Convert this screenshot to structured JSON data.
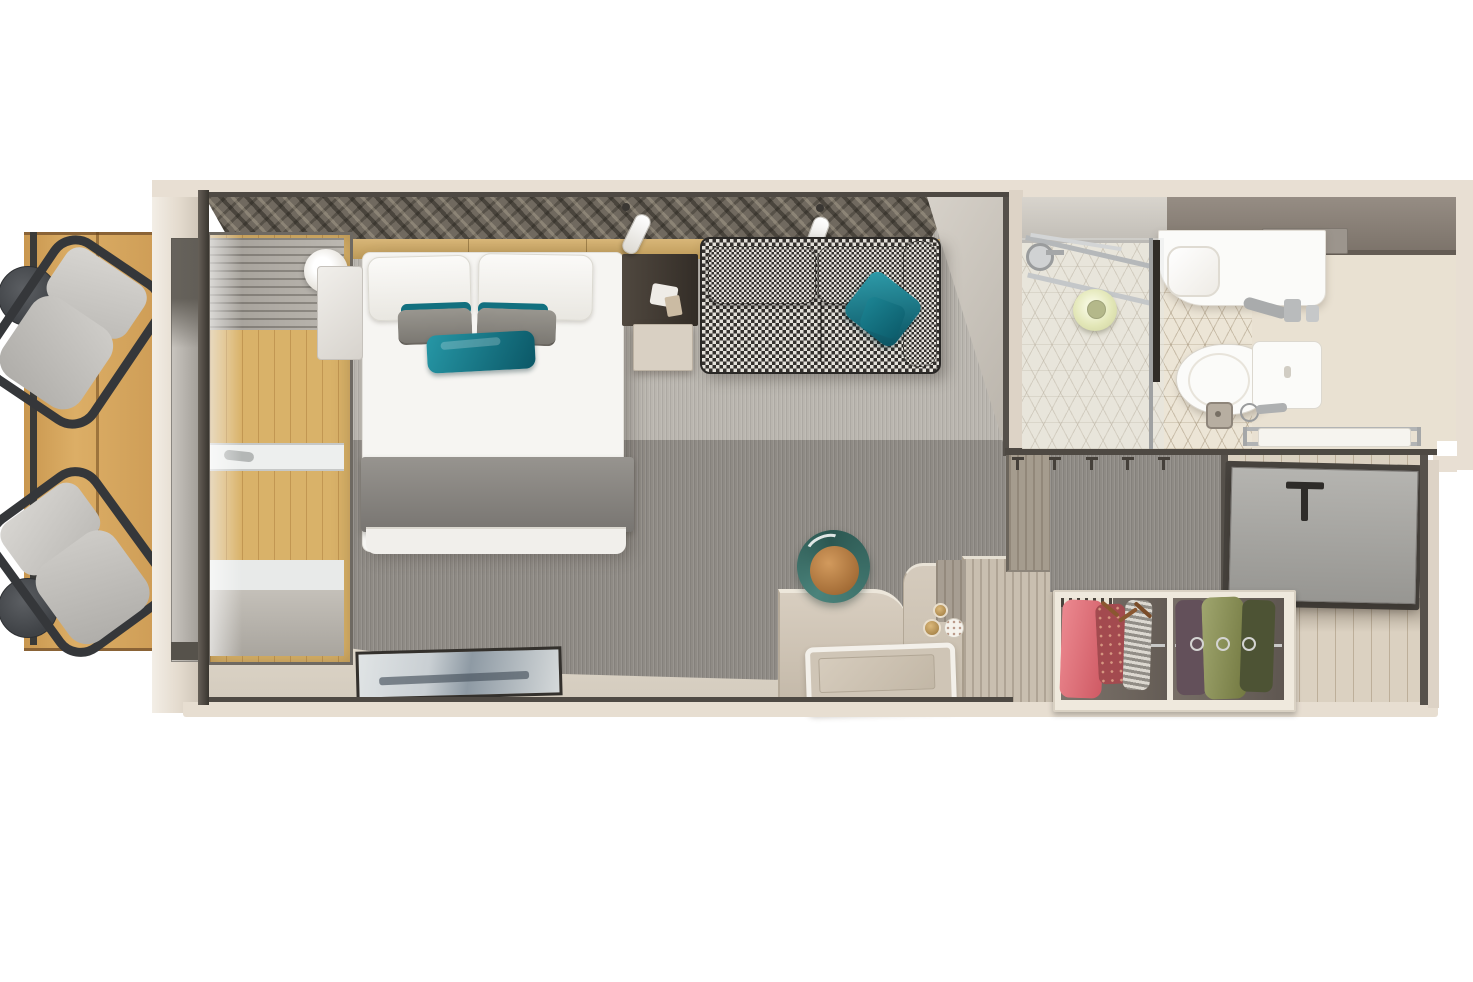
{
  "scene": {
    "type": "3d-floorplan-render",
    "description": "Top-down 3D render of a cruise ship balcony stateroom with balcony, bedroom, bathroom, closet and entry",
    "width_px": 1473,
    "height_px": 982,
    "visible_text": "none"
  },
  "palette": {
    "bg": "#ffffff",
    "wall-beige": "#e8dfd3",
    "wall-line": "#4e4943",
    "deck-wood": "#d3a25a",
    "carpet-dark": "#8f8b85",
    "carpet-light": "#bab6af",
    "mural-base": "#70695f",
    "gold-band": "#cda765",
    "bed-white": "#f6f5f2",
    "pillow-gray": "#8b8882",
    "accent-teal": "#12707f",
    "blanket-gray": "#8a8783",
    "nightstand-dark": "#433c34",
    "marble": "#ece9e4",
    "sofa-dark": "#33302d",
    "sofa-light": "#e4e1da",
    "bath-floor": "#e9e1d2",
    "vanity-taupe": "#8b8279",
    "porcelain": "#fbfbf9",
    "chrome": "#a9abac",
    "towel-ring-green": "#e7ebbc",
    "door-gray": "#a6a5a1",
    "entry-wood": "#dbd1c1",
    "closet-interior": "#6f6760",
    "clothes-pink": "#e0737b",
    "clothes-green": "#8d8f5e",
    "desk-wood": "#d1c7b9",
    "stool-teal": "#3c6f68",
    "stool-orange": "#bf8347",
    "tv-frame": "#33302c"
  },
  "areas": {
    "balcony": {
      "name": "balcony",
      "items": [
        "wood-decking",
        "railing",
        "side-table",
        "side-table",
        "lounge-chair",
        "lounge-chair"
      ]
    },
    "bedroom": {
      "name": "stateroom-bedroom",
      "items": [
        "wall-mural",
        "headboard-band",
        "wall-sconce",
        "marble-nightstand",
        "double-bed",
        "white-pillows",
        "gray-pillows",
        "teal-accent-pillow",
        "gray-throw-blanket",
        "dark-nightstand",
        "reading-light",
        "reading-light",
        "houndstooth-sofa",
        "teal-sofa-pillow",
        "window-wall",
        "wall-tv",
        "desk-console",
        "round-stool",
        "tray"
      ]
    },
    "bathroom": {
      "name": "bathroom",
      "items": [
        "shower-enclosure",
        "glass-panel",
        "shower-head",
        "towel-ring",
        "mirror-cabinet",
        "vanity-counter",
        "sink",
        "toilet",
        "floor-drain",
        "sprayer",
        "towel-rack"
      ]
    },
    "entry": {
      "name": "entry-hall",
      "items": [
        "coat-hooks",
        "slatted-panel",
        "luggage-bench",
        "entry-door",
        "door-handle",
        "open-closet",
        "hanging-clothes-pink",
        "hanging-clothes-green",
        "wood-floor"
      ]
    }
  }
}
